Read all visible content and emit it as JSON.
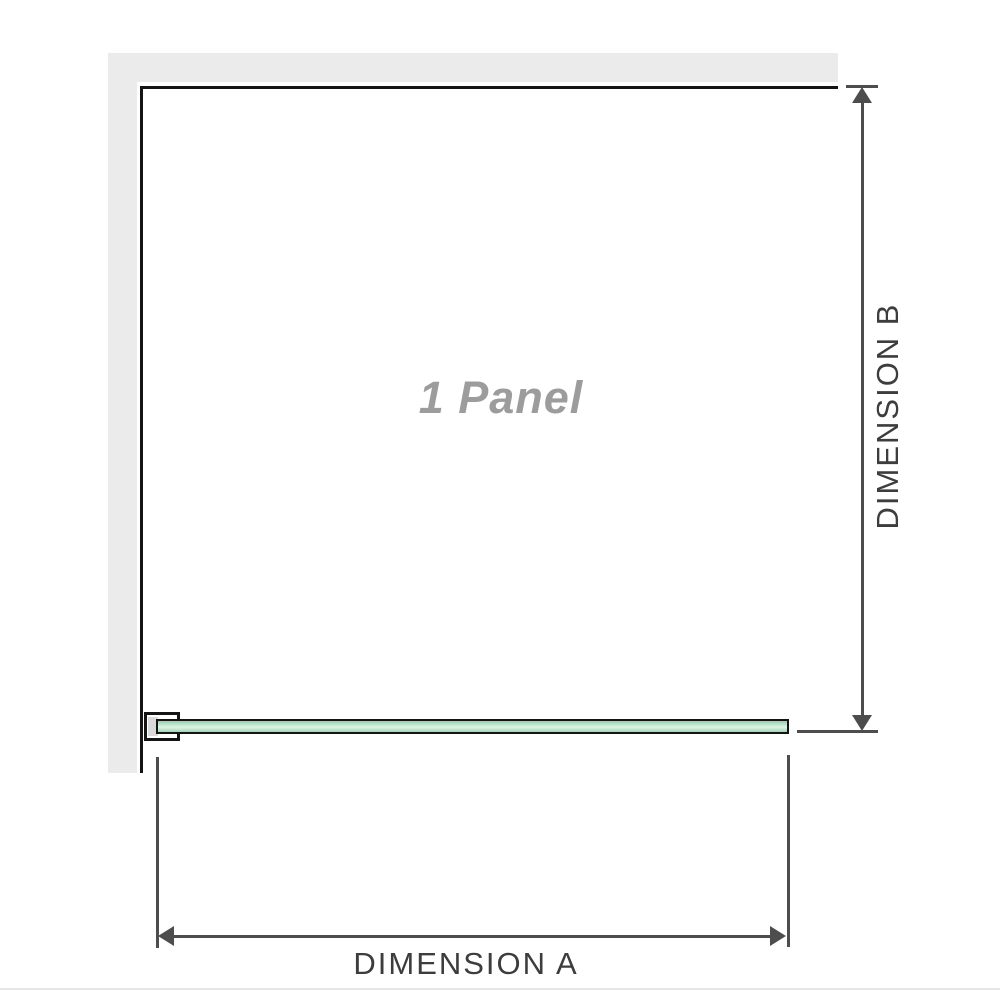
{
  "diagram": {
    "title_label": "1 Panel",
    "dimension_a": {
      "label": "DIMENSION A"
    },
    "dimension_b": {
      "label": "DIMENSION B"
    },
    "colors": {
      "wall": "#ebebeb",
      "edge": "#141414",
      "dimension_line": "#4d4d4d",
      "label_text": "#3d3d3d",
      "panel_label_text": "#9c9c9c",
      "glass_border": "#141414",
      "glass_fill_top": "#8fd0a8",
      "glass_fill_light": "#e0f3e7",
      "glass_fill_bottom": "#9fd8b2",
      "bracket_fill": "#ffffff",
      "bracket_insert": "#d9d9d9",
      "footer_divider": "#e3e8e3"
    }
  }
}
